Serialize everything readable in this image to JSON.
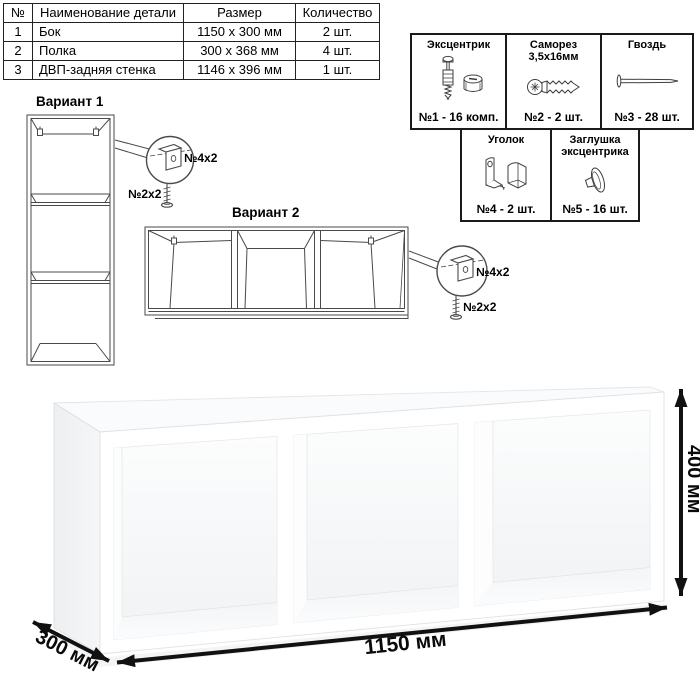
{
  "parts_table": {
    "headers": [
      "№",
      "Наименование детали",
      "Размер",
      "Количество"
    ],
    "rows": [
      {
        "num": "1",
        "name": "Бок",
        "size": "1150 x 300 мм",
        "qty": "2 шт."
      },
      {
        "num": "2",
        "name": "Полка",
        "size": "300 x 368 мм",
        "qty": "4 шт."
      },
      {
        "num": "3",
        "name": "ДВП-задняя стенка",
        "size": "1146 x 396 мм",
        "qty": "1 шт."
      }
    ]
  },
  "hardware": {
    "items": [
      {
        "title": "Эксцентрик",
        "count": "№1 - 16 комп.",
        "icon": "eccentric-and-cam-icon"
      },
      {
        "title": "Саморез 3,5х16мм",
        "count": "№2 - 2 шт.",
        "icon": "screw-icon"
      },
      {
        "title": "Гвоздь",
        "count": "№3 - 28 шт.",
        "icon": "nail-icon"
      },
      {
        "title": "Уголок",
        "count": "№4 - 2 шт.",
        "icon": "corner-bracket-icon"
      },
      {
        "title": "Заглушка эксцентрика",
        "count": "№5 - 16 шт.",
        "icon": "eccentric-cap-icon"
      }
    ]
  },
  "variant1": {
    "title": "Вариант 1",
    "bracket_label": "№4х2",
    "screw_label": "№2х2"
  },
  "variant2": {
    "title": "Вариант 2",
    "bracket_label": "№4х2",
    "screw_label": "№2х2"
  },
  "dimensions": {
    "width": "1150 мм",
    "height": "400 мм",
    "depth": "300 мм"
  },
  "colors": {
    "line": "#4a4a4a",
    "table_border": "#1a1a1a",
    "dimension": "#111111"
  }
}
